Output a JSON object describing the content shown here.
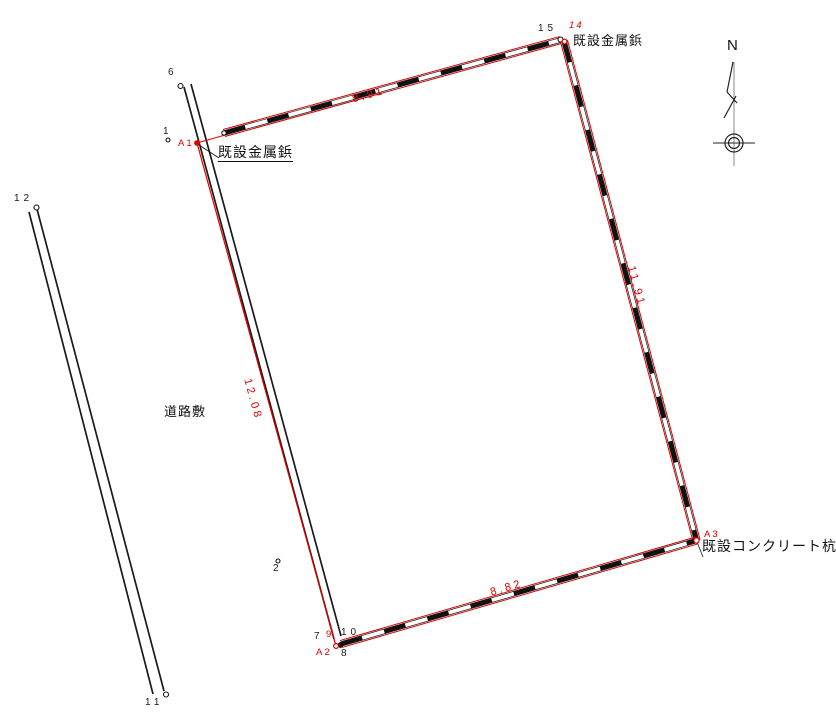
{
  "colors": {
    "boundary_red": "#dd0000",
    "line_black": "#1a1a1a"
  },
  "north": {
    "label": "N"
  },
  "texts": {
    "road_area": "道路敷",
    "marker_a1": "既設金属鋲",
    "marker_14": "既設金属鋲",
    "marker_a3": "既設コンクリート杭"
  },
  "dimensions": {
    "top": "8.91",
    "right": "11.91",
    "bottom": "8.82",
    "left": "12.08"
  },
  "points": {
    "p1": "1",
    "p2": "2",
    "p6": "6",
    "p7": "7",
    "p8": "8",
    "p9": "9",
    "p10": "10",
    "p11": "11",
    "p12": "12",
    "p14": "14",
    "p15": "15",
    "a1": "A1",
    "a2": "A2",
    "a3": "A3"
  }
}
